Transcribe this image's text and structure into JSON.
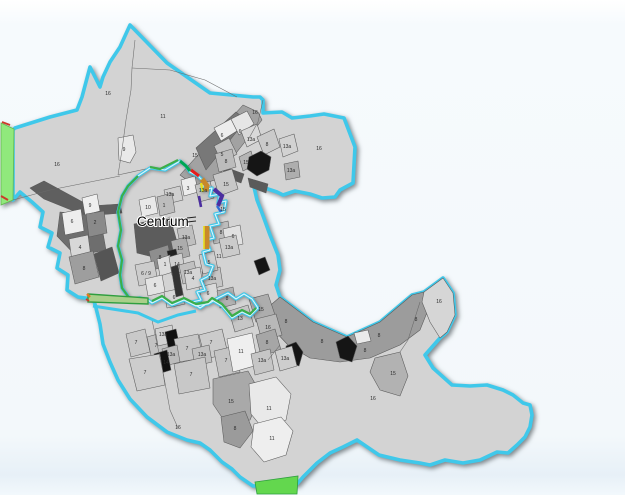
{
  "map": {
    "centrum_label": {
      "text": "Centrum"
    },
    "colors": {
      "background": "#f3f8fb",
      "plan_fill": "#d3d3d3",
      "boundary_cyan": "#3fc8ea",
      "green_edge": "#3cae4a",
      "left_strip_green": "#90e97c",
      "bottom_strip_green": "#63d74e",
      "accent_green": "#00a651",
      "accent_red": "#e31e1e",
      "accent_ochre": "#c8882b",
      "accent_yellow": "#e6de1f",
      "accent_violet": "#4b2ea0",
      "accent_blue": "#2f6fd6"
    },
    "parcel_labels": [
      {
        "t": "16",
        "x": 108,
        "y": 95
      },
      {
        "t": "11",
        "x": 163,
        "y": 118
      },
      {
        "t": "16",
        "x": 255,
        "y": 114
      },
      {
        "t": "9",
        "x": 124,
        "y": 151
      },
      {
        "t": "15",
        "x": 195,
        "y": 157
      },
      {
        "t": "6",
        "x": 222,
        "y": 137
      },
      {
        "t": "6",
        "x": 240,
        "y": 133
      },
      {
        "t": "13a",
        "x": 251,
        "y": 141
      },
      {
        "t": "5",
        "x": 222,
        "y": 156
      },
      {
        "t": "8",
        "x": 267,
        "y": 146
      },
      {
        "t": "15",
        "x": 246,
        "y": 164
      },
      {
        "t": "13a",
        "x": 287,
        "y": 148
      },
      {
        "t": "16",
        "x": 319,
        "y": 150
      },
      {
        "t": "13a",
        "x": 291,
        "y": 172
      },
      {
        "t": "8",
        "x": 226,
        "y": 163
      },
      {
        "t": "15",
        "x": 226,
        "y": 186
      },
      {
        "t": "13a",
        "x": 203,
        "y": 192
      },
      {
        "t": "3",
        "x": 188,
        "y": 190
      },
      {
        "t": "13a",
        "x": 170,
        "y": 196
      },
      {
        "t": "16",
        "x": 57,
        "y": 166
      },
      {
        "t": "9",
        "x": 90,
        "y": 207
      },
      {
        "t": "2",
        "x": 95,
        "y": 224
      },
      {
        "t": "6",
        "x": 72,
        "y": 223
      },
      {
        "t": "4",
        "x": 80,
        "y": 249
      },
      {
        "t": "8",
        "x": 84,
        "y": 270
      },
      {
        "t": "10",
        "x": 148,
        "y": 209
      },
      {
        "t": "1",
        "x": 164,
        "y": 207
      },
      {
        "t": "13a",
        "x": 186,
        "y": 239
      },
      {
        "t": "15",
        "x": 180,
        "y": 250
      },
      {
        "t": "8",
        "x": 160,
        "y": 259
      },
      {
        "t": "1",
        "x": 165,
        "y": 266
      },
      {
        "t": "14",
        "x": 177,
        "y": 266
      },
      {
        "t": "6 / 9",
        "x": 146,
        "y": 275
      },
      {
        "t": "13a",
        "x": 188,
        "y": 274
      },
      {
        "t": "6",
        "x": 155,
        "y": 287
      },
      {
        "t": "4",
        "x": 193,
        "y": 280
      },
      {
        "t": "13a",
        "x": 212,
        "y": 280
      },
      {
        "t": "6",
        "x": 174,
        "y": 299
      },
      {
        "t": "6",
        "x": 208,
        "y": 295
      },
      {
        "t": "8",
        "x": 227,
        "y": 300
      },
      {
        "t": "15",
        "x": 223,
        "y": 211
      },
      {
        "t": "8",
        "x": 221,
        "y": 234
      },
      {
        "t": "6",
        "x": 233,
        "y": 238
      },
      {
        "t": "13a",
        "x": 229,
        "y": 249
      },
      {
        "t": "5",
        "x": 209,
        "y": 264
      },
      {
        "t": "11",
        "x": 219,
        "y": 258
      },
      {
        "t": "15",
        "x": 261,
        "y": 311
      },
      {
        "t": "13",
        "x": 240,
        "y": 320
      },
      {
        "t": "16",
        "x": 268,
        "y": 329
      },
      {
        "t": "8",
        "x": 267,
        "y": 344
      },
      {
        "t": "7",
        "x": 136,
        "y": 344
      },
      {
        "t": "7",
        "x": 156,
        "y": 347
      },
      {
        "t": "13a",
        "x": 163,
        "y": 336
      },
      {
        "t": "7",
        "x": 187,
        "y": 350
      },
      {
        "t": "13a",
        "x": 171,
        "y": 356
      },
      {
        "t": "14",
        "x": 166,
        "y": 364
      },
      {
        "t": "13a",
        "x": 202,
        "y": 356
      },
      {
        "t": "7",
        "x": 211,
        "y": 344
      },
      {
        "t": "7",
        "x": 226,
        "y": 362
      },
      {
        "t": "11",
        "x": 241,
        "y": 353
      },
      {
        "t": "13a",
        "x": 262,
        "y": 362
      },
      {
        "t": "13a",
        "x": 285,
        "y": 360
      },
      {
        "t": "7",
        "x": 145,
        "y": 374
      },
      {
        "t": "7",
        "x": 191,
        "y": 376
      },
      {
        "t": "15",
        "x": 231,
        "y": 403
      },
      {
        "t": "11",
        "x": 269,
        "y": 410
      },
      {
        "t": "16",
        "x": 178,
        "y": 429
      },
      {
        "t": "8",
        "x": 235,
        "y": 430
      },
      {
        "t": "11",
        "x": 272,
        "y": 440
      },
      {
        "t": "8",
        "x": 286,
        "y": 323
      },
      {
        "t": "8",
        "x": 322,
        "y": 343
      },
      {
        "t": "8",
        "x": 365,
        "y": 352
      },
      {
        "t": "8",
        "x": 379,
        "y": 337
      },
      {
        "t": "8",
        "x": 416,
        "y": 321
      },
      {
        "t": "16",
        "x": 439,
        "y": 303
      },
      {
        "t": "15",
        "x": 393,
        "y": 375
      },
      {
        "t": "16",
        "x": 373,
        "y": 400
      }
    ]
  }
}
